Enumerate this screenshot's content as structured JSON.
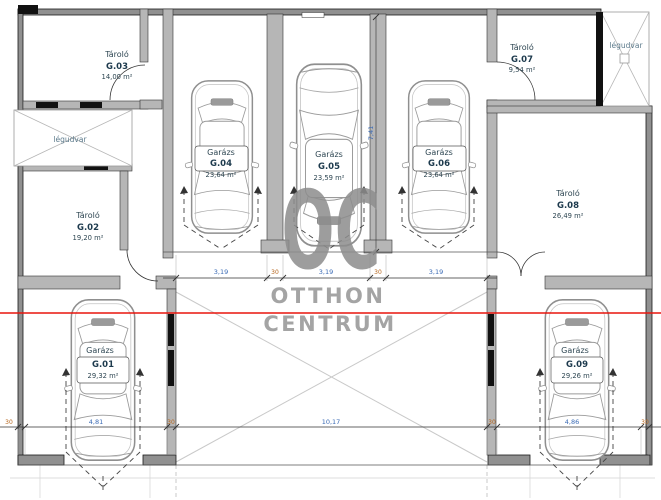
{
  "watermark": {
    "logo": "OC",
    "line1": "OTTHON",
    "line2": "CENTRUM"
  },
  "lightwells": {
    "left": "légudvar",
    "right": "légudvar"
  },
  "rooms": [
    {
      "type": "Garázs",
      "id": "G.01",
      "area": "29,32 m²"
    },
    {
      "type": "Tároló",
      "id": "G.02",
      "area": "19,20 m²"
    },
    {
      "type": "Tároló",
      "id": "G.03",
      "area": "14,00 m²"
    },
    {
      "type": "Garázs",
      "id": "G.04",
      "area": "23,64 m²"
    },
    {
      "type": "Garázs",
      "id": "G.05",
      "area": "23,59 m²"
    },
    {
      "type": "Garázs",
      "id": "G.06",
      "area": "23,64 m²"
    },
    {
      "type": "Tároló",
      "id": "G.07",
      "area": "9,54 m²"
    },
    {
      "type": "Tároló",
      "id": "G.08",
      "area": "26,49 m²"
    },
    {
      "type": "Garázs",
      "id": "G.09",
      "area": "29,26 m²"
    }
  ],
  "dimensions": {
    "garage_row": [
      "3,19",
      "30",
      "3,19",
      "30",
      "3,19"
    ],
    "depth": "7,41",
    "bottom_row": [
      "30",
      "4,81",
      "30",
      "10,17",
      "30",
      "4,86",
      "30"
    ]
  },
  "colors": {
    "red_line": "#e8150d",
    "wall_fill": "#b6b6b6",
    "outer_wall_fill": "#909090",
    "dim_text": "#3b6bb5",
    "wall_dim_text": "#b5651d",
    "room_text": "#2e4652",
    "watermark": "#8d8d8d"
  }
}
